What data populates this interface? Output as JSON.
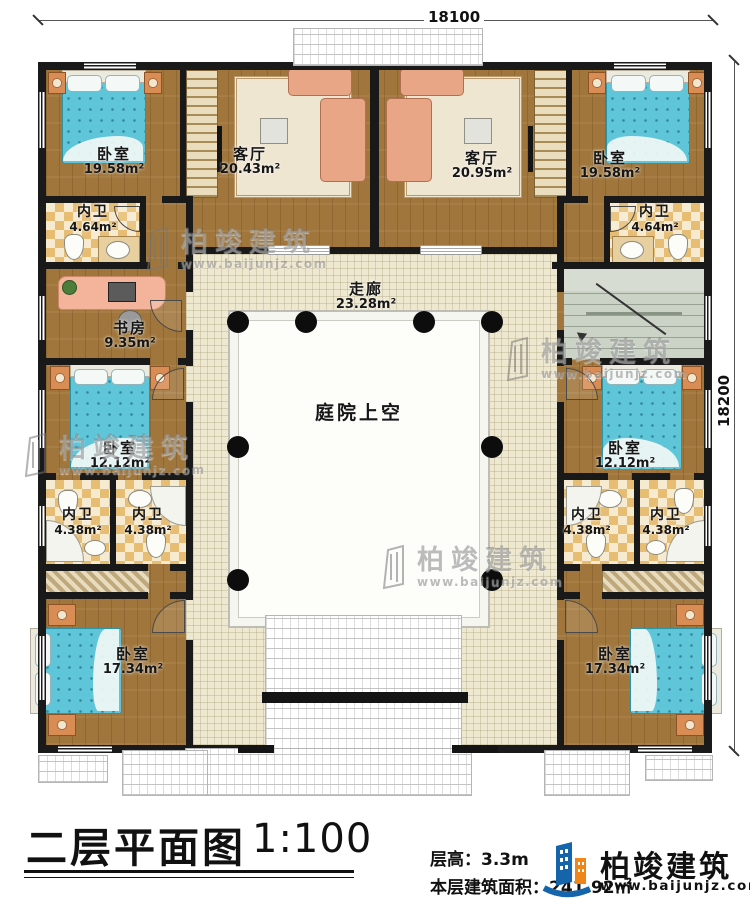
{
  "dimensions": {
    "top": "18100",
    "right": "18200"
  },
  "rooms": {
    "bedroom_tl": {
      "name": "卧室",
      "area": "19.58m²"
    },
    "living_l": {
      "name": "客厅",
      "area": "20.43m²"
    },
    "living_r": {
      "name": "客厅",
      "area": "20.95m²"
    },
    "bedroom_tr": {
      "name": "卧室",
      "area": "19.58m²"
    },
    "bath_tl": {
      "name": "内卫",
      "area": "4.64m²"
    },
    "bath_tr": {
      "name": "内卫",
      "area": "4.64m²"
    },
    "study": {
      "name": "书房",
      "area": "9.35m²"
    },
    "corridor": {
      "name": "走廊",
      "area": "23.28m²"
    },
    "courtyard": {
      "name": "庭院上空"
    },
    "bedroom_ml": {
      "name": "卧室",
      "area": "12.12m²"
    },
    "bedroom_mr": {
      "name": "卧室",
      "area": "12.12m²"
    },
    "bath_l1": {
      "name": "内卫",
      "area": "4.38m²"
    },
    "bath_l2": {
      "name": "内卫",
      "area": "4.38m²"
    },
    "bath_r1": {
      "name": "内卫",
      "area": "4.38m²"
    },
    "bath_r2": {
      "name": "内卫",
      "area": "4.38m²"
    },
    "bedroom_bl": {
      "name": "卧室",
      "area": "17.34m²"
    },
    "bedroom_br": {
      "name": "卧室",
      "area": "17.34m²"
    }
  },
  "title_block": {
    "title": "二层平面图",
    "scale": "1:100",
    "floor_height": "层高：3.3m",
    "floor_area": "本层建筑面积：241.92㎡"
  },
  "brand": {
    "name": "柏竣建筑",
    "website": "www.baijunjz.com"
  },
  "watermark": {
    "name": "柏竣建筑",
    "website": "www.baijunjz.com"
  },
  "colors": {
    "wall": "#1a1a1a",
    "wood": "#a0763c",
    "corridor": "#eee8d0",
    "tile": "#e7bd74",
    "bed": "#5fc6da",
    "brand_blue": "#1565ad",
    "brand_orange": "#f08519"
  }
}
